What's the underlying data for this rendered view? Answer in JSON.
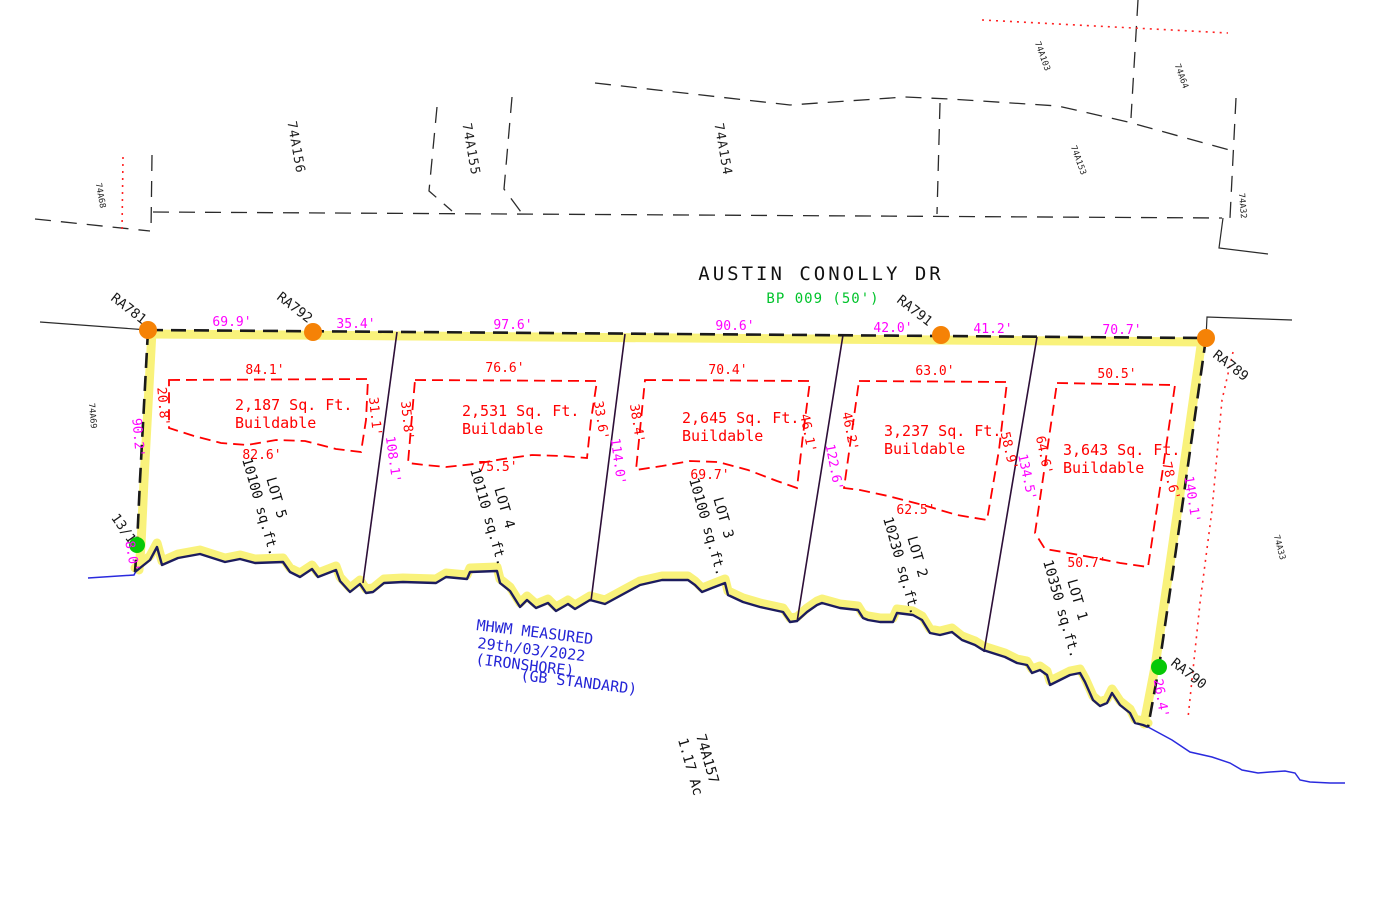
{
  "street": {
    "name": "AUSTIN CONOLLY DR",
    "plan": "BP 009 (50')"
  },
  "road_segments": [
    "69.9'",
    "35.4'",
    "97.6'",
    "90.6'",
    "42.0'",
    "41.2'",
    "70.7'"
  ],
  "survey_markers": {
    "ra781": "RA781",
    "ra792": "RA792",
    "ra791": "RA791",
    "ra789": "RA789",
    "ra790": "RA790",
    "ref_13_1": "13/1"
  },
  "boundary_measurements": {
    "west": "90.2'",
    "west_shore": "8.0'",
    "line_5_4": "108.1'",
    "line_4_3": "114.0'",
    "line_3_2": "122.6'",
    "line_2_1": "134.5'",
    "east": "140.1'",
    "east_shore": "26.4'"
  },
  "lots": [
    {
      "name": "LOT 5",
      "area": "10100 sq.ft.",
      "buildable": {
        "area": "2,187 Sq. Ft.",
        "label": "Buildable",
        "top": "84.1'",
        "left": "20.8'",
        "right": "31.1'",
        "bottom": "82.6'"
      }
    },
    {
      "name": "LOT 4",
      "area": "10110 sq.ft.",
      "buildable": {
        "area": "2,531 Sq. Ft.",
        "label": "Buildable",
        "top": "76.6'",
        "left": "35.8'",
        "right": "33.6'",
        "bottom": "75.5'"
      }
    },
    {
      "name": "LOT 3",
      "area": "10100 sq.ft.",
      "buildable": {
        "area": "2,645 Sq. Ft.",
        "label": "Buildable",
        "top": "70.4'",
        "left": "38.4'",
        "right": "46.1'",
        "bottom": "69.7'"
      }
    },
    {
      "name": "LOT 2",
      "area": "10230 sq.ft.",
      "buildable": {
        "area": "3,237 Sq. Ft.",
        "label": "Buildable",
        "top": "63.0'",
        "left": "46.2'",
        "right": "58.9'",
        "bottom": "62.5'"
      }
    },
    {
      "name": "LOT 1",
      "area": "10350 sq.ft.",
      "buildable": {
        "area": "3,643 Sq. Ft.",
        "label": "Buildable",
        "top": "50.5'",
        "left": "64.6'",
        "right": "78.6'",
        "bottom": "50.7'"
      }
    }
  ],
  "parcel": {
    "id": "74A157",
    "acreage": "1.17 Ac"
  },
  "adjacent_parcels": {
    "p74a68": "74A68",
    "p74a69": "74A69",
    "p74a156": "74A156",
    "p74a155": "74A155",
    "p74a154": "74A154",
    "p74a153": "74A153",
    "p74a103": "74A103",
    "p74a64": "74A64",
    "p74a32": "74A32",
    "p74a33": "74A33"
  },
  "mhwm_note": {
    "line1": "MHWM MEASURED",
    "line2": "29th/03/2022",
    "line3": "(IRONSHORE)",
    "line4": "(GB STANDARD)"
  },
  "colors": {
    "highlight_yellow": "#f9f27b",
    "boundary_black": "#1a1a1a",
    "shoreline_navy": "#1c1c5e",
    "lot_line": "#2d0f38",
    "dimension_magenta": "#ff00ff",
    "buildable_red": "#ff0000",
    "plan_green": "#00c32b",
    "marker_orange": "#f58206",
    "marker_green": "#06c806",
    "water_blue": "#2a2ade"
  }
}
